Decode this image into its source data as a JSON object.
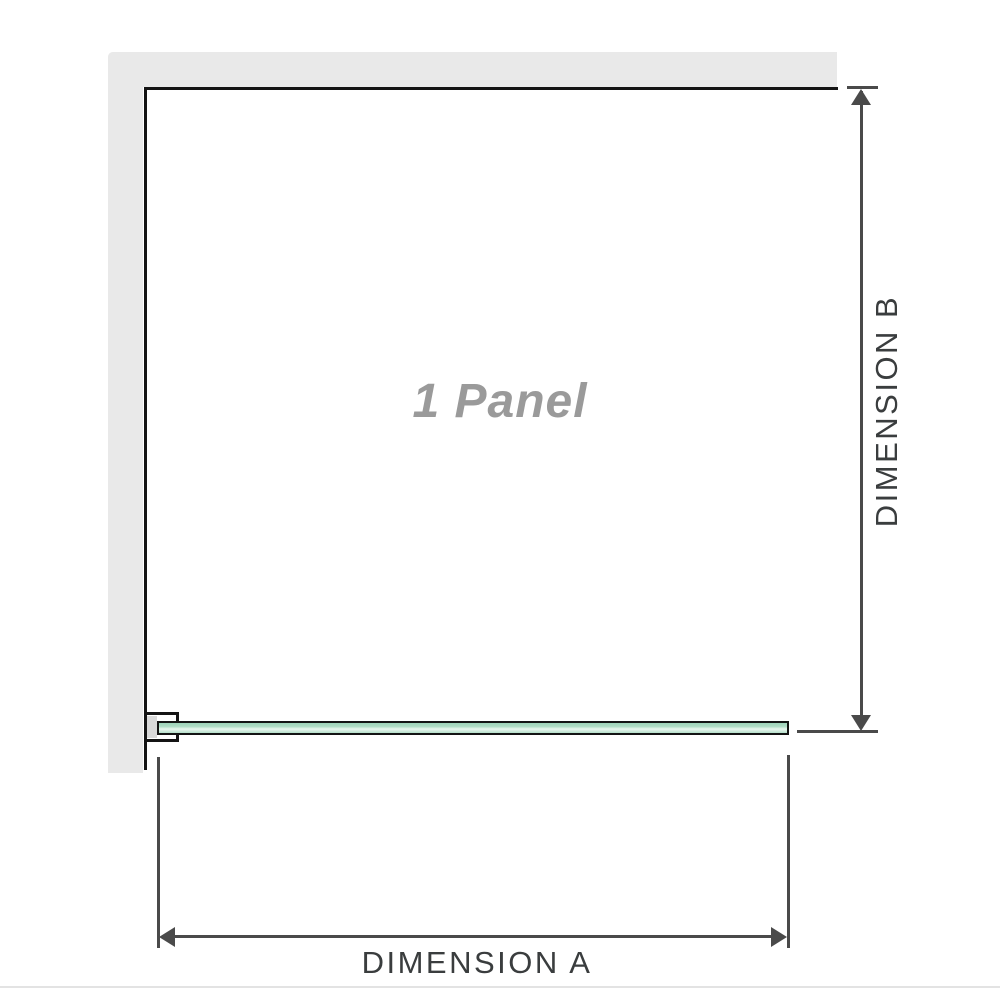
{
  "diagram": {
    "panel_label": "1 Panel",
    "dimensions": {
      "a_label": "DIMENSION A",
      "b_label": "DIMENSION B"
    }
  },
  "colors": {
    "wall": "#e9e9e9",
    "outline": "#141414",
    "dim": "#4a4a4a",
    "text": "#3a3d3e",
    "label": "#9a9a9a",
    "glass-mid": "#aedcc4",
    "glass-light": "#eaf7ef",
    "bracket": "#d9d9d9",
    "divider": "#e3e3e3"
  }
}
